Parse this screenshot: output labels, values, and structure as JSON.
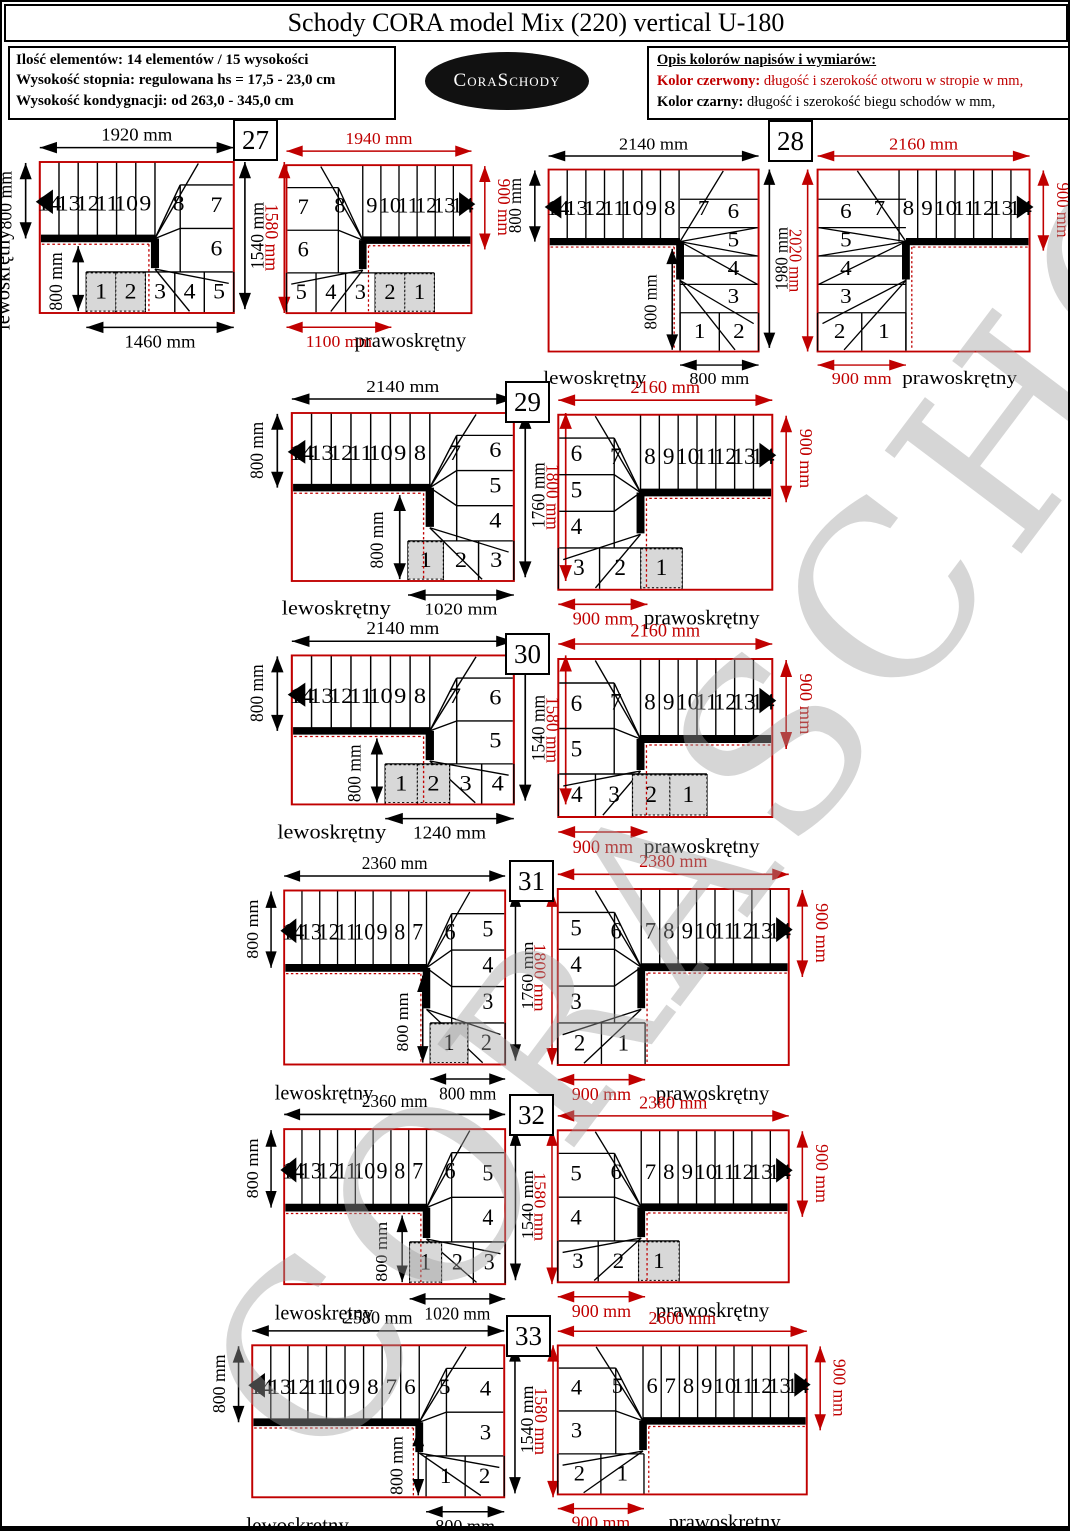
{
  "palette": {
    "red": "#c00000",
    "black": "#000000",
    "shade": "#d8d8d8",
    "watermark_gray": "#9f9f9f"
  },
  "header": {
    "title": "Schody CORA model Mix (220) vertical U-180"
  },
  "info": {
    "line1": "Ilość elementów: 14 elementów / 15 wysokości",
    "line2": "Wysokość stopnia: regulowana  hs = 17,5 - 23,0 cm",
    "line3": "Wysokość kondygnacji: od 263,0 - 345,0 cm"
  },
  "legend": {
    "title": "Opis kolorów napisów i wymiarów:",
    "red_lead": "Kolor czerwony:",
    "red_rest": " długość i szerokość otworu w stropie w mm,",
    "black_lead": "Kolor czarny:",
    "black_rest": " długość i szerokość biegu schodów w mm,"
  },
  "logo": {
    "text": "CoraSchody"
  },
  "watermark": {
    "text": "CORASCHODY"
  },
  "sections": [
    {
      "num": "27",
      "left": {
        "type": "rect",
        "mirror": false,
        "W": 1920,
        "H": 1580,
        "top_dim": {
          "text": "1920 mm",
          "color": "black"
        },
        "band_dim": {
          "text": "800 mm",
          "color": "black",
          "len": 800
        },
        "inner_dim": {
          "text": "800 mm"
        },
        "straight": [
          "14",
          "13",
          "12",
          "11",
          "10",
          "9"
        ],
        "fan": "8",
        "side": [
          "7",
          "6"
        ],
        "row": [
          "1",
          "2",
          "3",
          "4",
          "5"
        ],
        "row_span": 1460,
        "shaded": [
          0,
          1
        ],
        "bottom_dim": {
          "text": "1460 mm",
          "color": "black",
          "span": 1460
        },
        "side_dims": [
          {
            "text": "1540 mm",
            "color": "black",
            "len": 1540
          },
          {
            "text": "1580 mm",
            "color": "red",
            "len": 1580
          }
        ],
        "turn_label": {
          "text": "lewoskrętny",
          "vertical": true,
          "x_frac": 0.2
        }
      },
      "right": {
        "type": "rect",
        "mirror": true,
        "W": 1940,
        "H": 1580,
        "top_dim": {
          "text": "1940 mm",
          "color": "red"
        },
        "band_dim": {
          "text": "900 mm",
          "color": "red",
          "len": 900
        },
        "inner_dim": null,
        "straight": [
          "14",
          "13",
          "12",
          "11",
          "10",
          "9"
        ],
        "fan": "8",
        "side": [
          "7",
          "6"
        ],
        "row": [
          "1",
          "2",
          "3",
          "4",
          "5"
        ],
        "row_span": 1550,
        "shaded": [
          0,
          1
        ],
        "bottom_dim": {
          "text": "1100 mm",
          "color": "red",
          "span": 1100
        },
        "side_dims": [],
        "turn_label": {
          "text": "prawoskrętny",
          "vertical": false,
          "x_frac": 0.33
        }
      }
    },
    {
      "num": "28",
      "left": {
        "type": "col",
        "mirror": false,
        "W": 2140,
        "H": 2020,
        "col_w": 800,
        "top_dim": {
          "text": "2140 mm",
          "color": "black"
        },
        "band_dim": {
          "text": "800 mm",
          "color": "black",
          "len": 800
        },
        "inner_dim": {
          "text": "800 mm"
        },
        "straight": [
          "14",
          "13",
          "12",
          "11",
          "10",
          "9",
          "8"
        ],
        "fan": "7",
        "side": [
          "6",
          "5",
          "4",
          "3"
        ],
        "row": [
          "1",
          "2"
        ],
        "row_span": 800,
        "shaded": [],
        "bottom_dim": {
          "text": "800 mm",
          "color": "black",
          "span": 800
        },
        "side_dims": [
          {
            "text": "1980 mm",
            "color": "black",
            "len": 1980
          },
          {
            "text": "2020 mm",
            "color": "red",
            "len": 2020
          }
        ],
        "turn_label": {
          "text": "lewoskrętny",
          "vertical": false,
          "x_frac": 0.22
        }
      },
      "right": {
        "type": "col",
        "mirror": true,
        "W": 2160,
        "H": 2020,
        "col_w": 900,
        "top_dim": {
          "text": "2160 mm",
          "color": "red"
        },
        "band_dim": {
          "text": "900 mm",
          "color": "red",
          "len": 900
        },
        "inner_dim": null,
        "straight": [
          "14",
          "13",
          "12",
          "11",
          "10",
          "9",
          "8"
        ],
        "fan": "7",
        "side": [
          "6",
          "5",
          "4",
          "3"
        ],
        "row": [
          "1",
          "2"
        ],
        "row_span": 900,
        "shaded": [],
        "bottom_dim": {
          "text": "900 mm",
          "color": "red",
          "span": 900
        },
        "side_dims": [],
        "turn_label": {
          "text": "prawoskrętny",
          "vertical": false,
          "x_frac": 0.33
        }
      }
    },
    {
      "num": "29",
      "left": {
        "type": "rect",
        "mirror": false,
        "W": 2140,
        "H": 1800,
        "top_dim": {
          "text": "2140 mm",
          "color": "black"
        },
        "band_dim": {
          "text": "800 mm",
          "color": "black",
          "len": 800
        },
        "inner_dim": {
          "text": "800 mm"
        },
        "straight": [
          "14",
          "13",
          "12",
          "11",
          "10",
          "9",
          "8"
        ],
        "fan": "7",
        "side": [
          "6",
          "5",
          "4"
        ],
        "row": [
          "1",
          "2",
          "3"
        ],
        "row_span": 1020,
        "shaded": [
          0
        ],
        "bottom_dim": {
          "text": "1020 mm",
          "color": "black",
          "span": 1020
        },
        "side_dims": [
          {
            "text": "1760 mm",
            "color": "black",
            "len": 1760
          },
          {
            "text": "1800 mm",
            "color": "red",
            "len": 1800
          }
        ],
        "turn_label": {
          "text": "lewoskrętny",
          "vertical": false,
          "x_frac": 0.2
        }
      },
      "right": {
        "type": "rect",
        "mirror": true,
        "W": 2160,
        "H": 1800,
        "top_dim": {
          "text": "2160 mm",
          "color": "red"
        },
        "band_dim": {
          "text": "900 mm",
          "color": "red",
          "len": 900
        },
        "inner_dim": null,
        "straight": [
          "14",
          "13",
          "12",
          "11",
          "10",
          "9",
          "8"
        ],
        "fan": "7",
        "side": [
          "6",
          "5",
          "4"
        ],
        "row": [
          "1",
          "2",
          "3"
        ],
        "row_span": 1250,
        "shaded": [
          0
        ],
        "bottom_dim": {
          "text": "900 mm",
          "color": "red",
          "span": 900
        },
        "side_dims": [],
        "turn_label": {
          "text": "prawoskrętny",
          "vertical": false,
          "x_frac": 0.33
        }
      }
    },
    {
      "num": "30",
      "left": {
        "type": "rect",
        "mirror": false,
        "W": 2140,
        "H": 1580,
        "top_dim": {
          "text": "2140 mm",
          "color": "black"
        },
        "band_dim": {
          "text": "800 mm",
          "color": "black",
          "len": 800
        },
        "inner_dim": {
          "text": "800 mm"
        },
        "straight": [
          "14",
          "13",
          "12",
          "11",
          "10",
          "9",
          "8"
        ],
        "fan": "7",
        "side": [
          "6",
          "5"
        ],
        "row": [
          "1",
          "2",
          "3",
          "4"
        ],
        "row_span": 1240,
        "shaded": [
          0,
          1
        ],
        "bottom_dim": {
          "text": "1240 mm",
          "color": "black",
          "span": 1240
        },
        "side_dims": [
          {
            "text": "1540 mm",
            "color": "black",
            "len": 1540
          },
          {
            "text": "1580 mm",
            "color": "red",
            "len": 1580
          }
        ],
        "turn_label": {
          "text": "lewoskrętny",
          "vertical": false,
          "x_frac": 0.18
        }
      },
      "right": {
        "type": "rect",
        "mirror": true,
        "W": 2160,
        "H": 1580,
        "top_dim": {
          "text": "2160 mm",
          "color": "red"
        },
        "band_dim": {
          "text": "900 mm",
          "color": "red",
          "len": 900
        },
        "inner_dim": null,
        "straight": [
          "14",
          "13",
          "12",
          "11",
          "10",
          "9",
          "8"
        ],
        "fan": "7",
        "side": [
          "6",
          "5"
        ],
        "row": [
          "1",
          "2",
          "3",
          "4"
        ],
        "row_span": 1500,
        "shaded": [
          0,
          1
        ],
        "bottom_dim": {
          "text": "900 mm",
          "color": "red",
          "span": 900
        },
        "side_dims": [],
        "turn_label": {
          "text": "prawoskrętny",
          "vertical": false,
          "x_frac": 0.33
        }
      }
    },
    {
      "num": "31",
      "left": {
        "type": "rect",
        "mirror": false,
        "W": 2360,
        "H": 1800,
        "top_dim": {
          "text": "2360 mm",
          "color": "black"
        },
        "band_dim": {
          "text": "800 mm",
          "color": "black",
          "len": 800
        },
        "inner_dim": {
          "text": "800 mm"
        },
        "straight": [
          "14",
          "13",
          "12",
          "11",
          "10",
          "9",
          "8",
          "7"
        ],
        "fan": "6",
        "side": [
          "5",
          "4",
          "3"
        ],
        "row": [
          "1",
          "2"
        ],
        "row_span": 800,
        "shaded": [
          0
        ],
        "bottom_dim": {
          "text": "800 mm",
          "color": "black",
          "span": 800
        },
        "side_dims": [
          {
            "text": "1760 mm",
            "color": "black",
            "len": 1760
          },
          {
            "text": "1800 mm",
            "color": "red",
            "len": 1800
          }
        ],
        "turn_label": {
          "text": "lewoskrętny",
          "vertical": false,
          "x_frac": 0.18
        }
      },
      "right": {
        "type": "rect",
        "mirror": true,
        "W": 2380,
        "H": 1800,
        "top_dim": {
          "text": "2380 mm",
          "color": "red"
        },
        "band_dim": {
          "text": "900 mm",
          "color": "red",
          "len": 900
        },
        "inner_dim": null,
        "straight": [
          "14",
          "13",
          "12",
          "11",
          "10",
          "9",
          "8",
          "7"
        ],
        "fan": "6",
        "side": [
          "5",
          "4",
          "3"
        ],
        "row": [
          "1",
          "2"
        ],
        "row_span": 900,
        "shaded": [],
        "bottom_dim": {
          "text": "900 mm",
          "color": "red",
          "span": 900
        },
        "side_dims": [],
        "turn_label": {
          "text": "prawoskrętny",
          "vertical": false,
          "x_frac": 0.33
        }
      }
    },
    {
      "num": "32",
      "left": {
        "type": "rect",
        "mirror": false,
        "W": 2360,
        "H": 1580,
        "top_dim": {
          "text": "2360 mm",
          "color": "black"
        },
        "band_dim": {
          "text": "800 mm",
          "color": "black",
          "len": 800
        },
        "inner_dim": {
          "text": "800 mm"
        },
        "straight": [
          "14",
          "13",
          "12",
          "11",
          "10",
          "9",
          "8",
          "7"
        ],
        "fan": "6",
        "side": [
          "5",
          "4"
        ],
        "row": [
          "1",
          "2",
          "3"
        ],
        "row_span": 1020,
        "shaded": [
          0
        ],
        "bottom_dim": {
          "text": "1020 mm",
          "color": "black",
          "span": 1020
        },
        "side_dims": [
          {
            "text": "1540 mm",
            "color": "black",
            "len": 1540
          },
          {
            "text": "1580 mm",
            "color": "red",
            "len": 1580
          }
        ],
        "turn_label": {
          "text": "lewoskrętny",
          "vertical": false,
          "x_frac": 0.18
        }
      },
      "right": {
        "type": "rect",
        "mirror": true,
        "W": 2380,
        "H": 1580,
        "top_dim": {
          "text": "2380 mm",
          "color": "red"
        },
        "band_dim": {
          "text": "900 mm",
          "color": "red",
          "len": 900
        },
        "inner_dim": null,
        "straight": [
          "14",
          "13",
          "12",
          "11",
          "10",
          "9",
          "8",
          "7"
        ],
        "fan": "6",
        "side": [
          "5",
          "4"
        ],
        "row": [
          "1",
          "2",
          "3"
        ],
        "row_span": 1250,
        "shaded": [
          0
        ],
        "bottom_dim": {
          "text": "900 mm",
          "color": "red",
          "span": 900
        },
        "side_dims": [],
        "turn_label": {
          "text": "prawoskrętny",
          "vertical": false,
          "x_frac": 0.33
        }
      }
    },
    {
      "num": "33",
      "left": {
        "type": "rect",
        "mirror": false,
        "W": 2580,
        "H": 1580,
        "top_dim": {
          "text": "2580 mm",
          "color": "black"
        },
        "band_dim": {
          "text": "800 mm",
          "color": "black",
          "len": 800
        },
        "inner_dim": {
          "text": "800 mm"
        },
        "straight": [
          "14",
          "13",
          "12",
          "11",
          "10",
          "9",
          "8",
          "7",
          "6"
        ],
        "fan": "5",
        "side": [
          "4",
          "3"
        ],
        "row": [
          "1",
          "2"
        ],
        "row_span": 800,
        "shaded": [],
        "bottom_dim": {
          "text": "800 mm",
          "color": "black",
          "span": 800
        },
        "side_dims": [
          {
            "text": "1540 mm",
            "color": "black",
            "len": 1540
          },
          {
            "text": "1580 mm",
            "color": "red",
            "len": 1580
          }
        ],
        "turn_label": {
          "text": "lewoskrętny",
          "vertical": false,
          "x_frac": 0.18
        }
      },
      "right": {
        "type": "rect",
        "mirror": true,
        "W": 2600,
        "H": 1580,
        "top_dim": {
          "text": "2600 mm",
          "color": "red"
        },
        "band_dim": {
          "text": "900 mm",
          "color": "red",
          "len": 900
        },
        "inner_dim": null,
        "straight": [
          "14",
          "13",
          "12",
          "11",
          "10",
          "9",
          "8",
          "7",
          "6"
        ],
        "fan": "5",
        "side": [
          "4",
          "3"
        ],
        "row": [
          "1",
          "2"
        ],
        "row_span": 900,
        "shaded": [],
        "bottom_dim": {
          "text": "900 mm",
          "color": "red",
          "span": 900
        },
        "side_dims": [],
        "turn_label": {
          "text": "prawoskrętny",
          "vertical": false,
          "x_frac": 0.33
        }
      }
    }
  ]
}
